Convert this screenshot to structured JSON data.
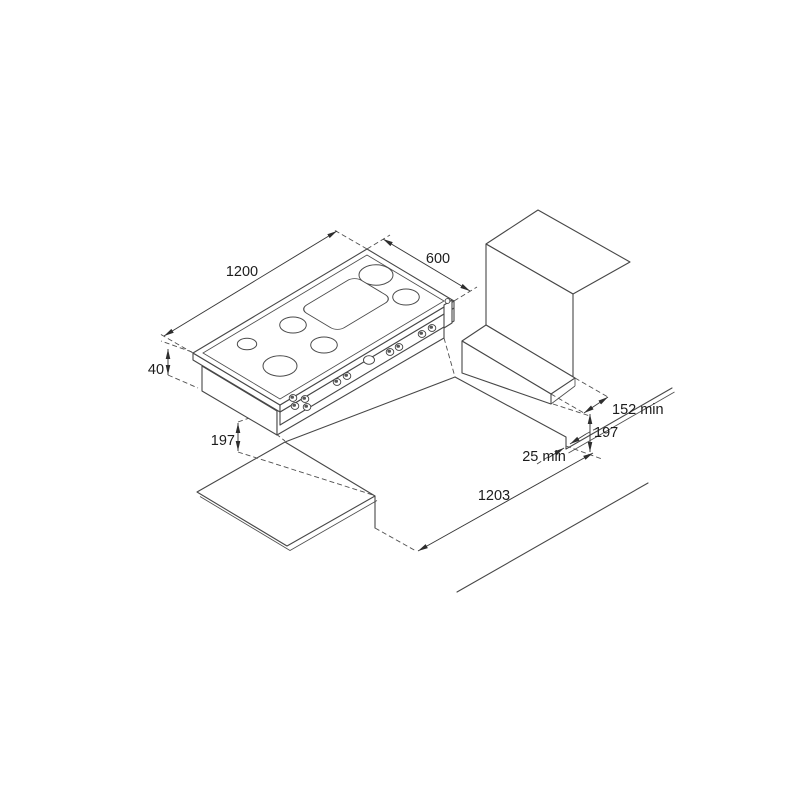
{
  "drawing": {
    "kind": "isometric installation diagram of a built-in gas hob over a worktop cutout",
    "background_color": "#ffffff",
    "line_color": "#474747",
    "hob": {
      "burner_count": 6,
      "control_knob_count": 10
    },
    "dimensions": {
      "hob_width": "1200",
      "hob_depth": "600",
      "hob_top_thickness": "40",
      "hob_chassis_depth": "197",
      "rear_clearance_min": "152 min",
      "step_height": "197",
      "side_gap_min": "25 min",
      "cutout_length": "1203"
    }
  }
}
